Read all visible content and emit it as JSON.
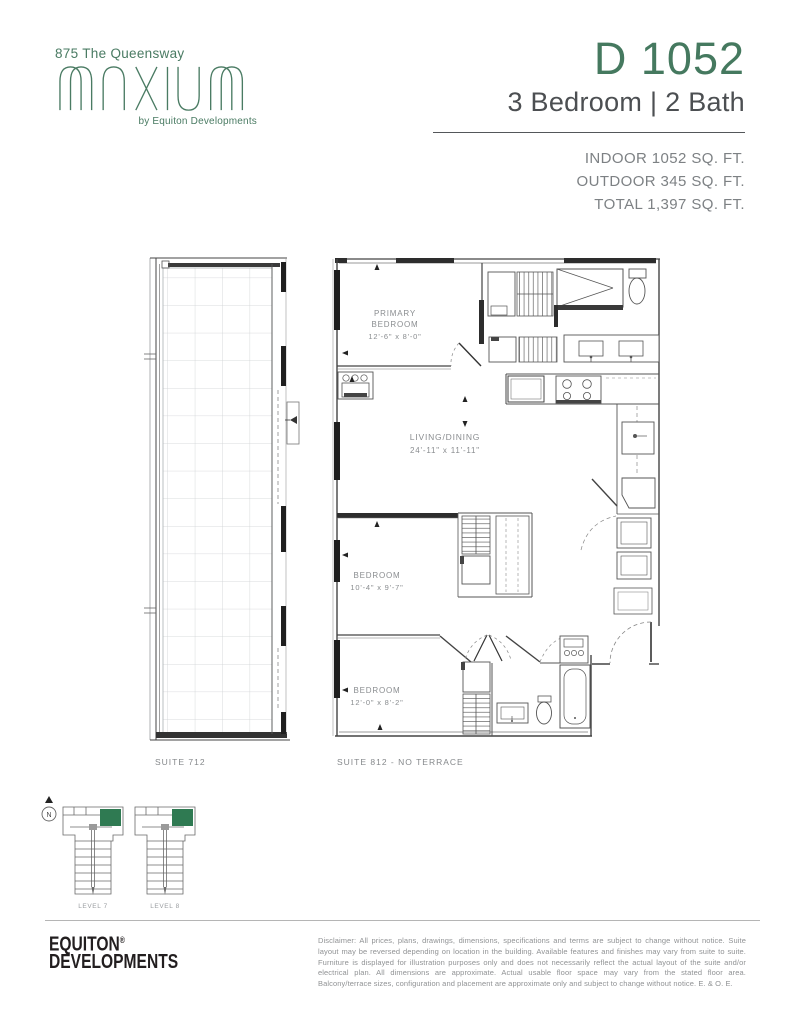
{
  "header": {
    "project_name": "875 The Queensway",
    "logo_word": "MAXIUM",
    "logo_byline": "by Equiton Developments",
    "unit_code": "D 1052",
    "unit_type": "3 Bedroom | 2 Bath",
    "area_lines": [
      "INDOOR 1052 SQ. FT.",
      "OUTDOOR 345 SQ. FT.",
      "TOTAL 1,397 SQ. FT."
    ]
  },
  "floor_plan": {
    "rooms": {
      "primary": {
        "line1": "PRIMARY",
        "line2": "BEDROOM",
        "dims": "12'-6\" x 8'-0\""
      },
      "living": {
        "name": "LIVING/DINING",
        "dims": "24'-11\" x 11'-11\""
      },
      "bedroom2": {
        "name": "BEDROOM",
        "dims": "10'-4\" x 9'-7\""
      },
      "bedroom3": {
        "name": "BEDROOM",
        "dims": "12'-0\" x 8'-2\""
      }
    },
    "suite_labels": {
      "terrace": "SUITE 712",
      "unit": "SUITE 812 - NO TERRACE"
    }
  },
  "key_plans": {
    "north": "N",
    "levels": [
      "LEVEL 7",
      "LEVEL 8"
    ]
  },
  "footer": {
    "brand_line1": "EQUITON",
    "brand_reg": "®",
    "brand_line2": "DEVELOPMENTS",
    "disclaimer": "Disclaimer: All prices, plans, drawings, dimensions, specifications and terms are subject to change without notice. Suite layout may be reversed depending on location in the building. Available features and finishes may vary from suite to suite. Furniture is displayed for illustration purposes only and does not necessarily reflect the actual layout of the suite and/or electrical plan. All dimensions are approximate. Actual usable floor space may vary from the stated floor area. Balcony/terrace sizes, configuration and placement are approximate only and subject to change without notice. E. & O. E."
  },
  "colors": {
    "brand_green": "#45795f",
    "keyplan_green": "#2f7a52",
    "wall_dark": "#2d2d2d",
    "text_gray": "#8a8d90"
  }
}
